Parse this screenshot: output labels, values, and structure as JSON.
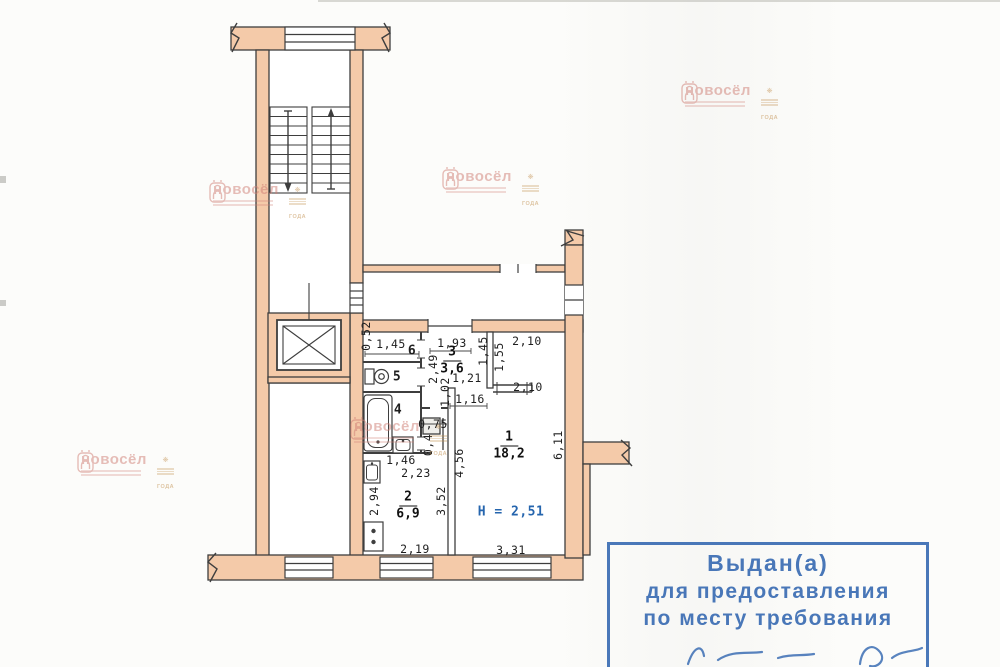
{
  "document_type": "floor-plan-scan",
  "colors": {
    "wall_fill": "#f4caa9",
    "line": "#3e3e3e",
    "stamp_blue": "#3c6eb4",
    "watermark_pink": "#cf7d74",
    "award_gold": "#c08d4b",
    "height_note_blue": "#2565ae"
  },
  "rooms": {
    "living": {
      "number": "1",
      "area": "18,2"
    },
    "kitchen": {
      "number": "2",
      "area": "6,9"
    },
    "hall": {
      "number": "3",
      "area": "3,6"
    },
    "bathroom": {
      "number": "4"
    },
    "wc": {
      "number": "5"
    },
    "closet": {
      "number": "6"
    }
  },
  "dims": {
    "niche052": "0,52",
    "closet_w": "1,45",
    "hall_w": "1,93",
    "r1_top1": "2,10",
    "niche_v145": "1,45",
    "niche_v155": "1,55",
    "hall_h": "2,49",
    "hall_121": "1,21",
    "hall_102": "1,02",
    "hall_116": "1,16",
    "r1_top2": "2,10",
    "vent_w": "0,75",
    "vent_h": "0,4",
    "bath_w": "1,46",
    "kitchen_w": "2,23",
    "r1_left_h": "4,56",
    "kitchen_h": "2,94",
    "kitchen_right_h": "3,52",
    "r1_right_h": "6,11",
    "kitchen_win": "2,19",
    "r1_win": "3,31",
    "ceiling": "H = 2,51"
  },
  "stamp": {
    "line1": "Выдан(а)",
    "line2": "для предоставления",
    "line3": "по месту требования"
  },
  "watermark": {
    "brand": "новосёл",
    "award": "ГОДА"
  }
}
